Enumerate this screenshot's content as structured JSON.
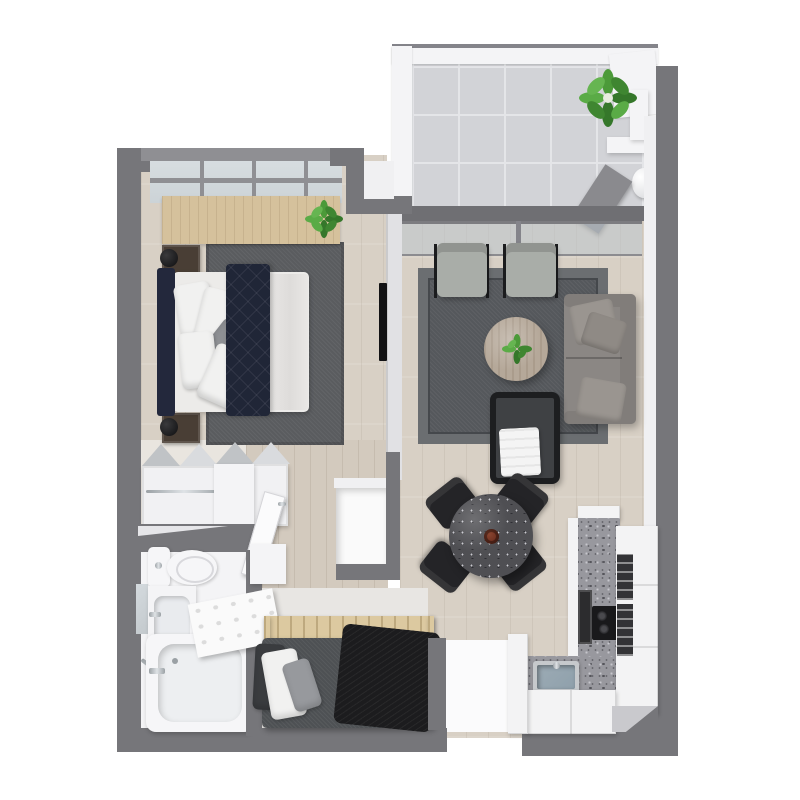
{
  "meta": {
    "title": "3D apartment floor plan render, top-down view",
    "render_type": "3d-floor-plan",
    "canvas": {
      "width": 800,
      "height": 800
    },
    "visible_text": "none"
  },
  "palette": {
    "wall": "#76767a",
    "wall_light": "#8f8f93",
    "wall_face": "#f0f0f2",
    "floor_wood": "#d8d0c5",
    "hall_wood": "#d3cabe",
    "den_floor": "#e8e6e3",
    "bath_floor": "#f4f4f6",
    "closet_floor": "#e9e5df",
    "tile": "#d2d3d7",
    "tile_line": "#e4e5e8",
    "rug_dark": "#5a5c5f",
    "rug_living": "#55585c",
    "rug_border": "#6b6e71",
    "navy": "#202637",
    "navy_dark": "#23283c",
    "mattress": "#ecebe9",
    "pillow": "#f1f1f0",
    "wood_desk": "#d5c19c",
    "wood_slat": "#dcc9a0",
    "nightstand": "#493e35",
    "sofa": "#8b8784",
    "sofa_pillow": "#9a9590",
    "chair_fabric": "#a9ada8",
    "table_wood": "#b5a899",
    "stone_table": "#4f4f53",
    "vase": "#5c2317",
    "chair_black": "#242427",
    "granite": "#98989e",
    "cabinet_white": "#f3f3f4",
    "appliance_dark": "#2c2c2e",
    "sink": "#8fa0ab",
    "plant_green": "#4c9a39",
    "plant_dark": "#35772a",
    "blanket_white": "#f4f4f4",
    "den_duvet": "#4e5154",
    "throw_black": "#1c1c1e",
    "glass": "#ccd3d7",
    "mirror": "#c3c9cd",
    "white_fixture": "#f4f4f6"
  },
  "rooms": [
    {
      "id": "balcony",
      "label": "balcony",
      "furniture": [
        "potted-plant",
        "water-heater-unit",
        "utility-door",
        "sliding-glass-door",
        "tile-floor"
      ]
    },
    {
      "id": "bedroom",
      "label": "bedroom",
      "furniture": [
        "window-wall",
        "wood-desk-counter",
        "desk-plant",
        "nightstand-left-top",
        "nightstand-left-bottom",
        "table-lamp-top",
        "table-lamp-bottom",
        "queen-bed",
        "headboard",
        "white-pillows",
        "gray-accent-pillow",
        "navy-quilted-duvet",
        "area-rug",
        "wall-mounted-tv"
      ]
    },
    {
      "id": "living-room",
      "label": "living-room",
      "furniture": [
        "accent-chair-left",
        "accent-chair-right",
        "round-wood-coffee-table",
        "coffee-table-plant",
        "gray-sofa",
        "sofa-pillows",
        "black-lounge-chair",
        "white-throw-blanket",
        "area-rug"
      ]
    },
    {
      "id": "dining-area",
      "label": "dining-area",
      "furniture": [
        "round-stone-dining-table",
        "center-vase",
        "dining-chair-nw",
        "dining-chair-ne",
        "dining-chair-sw",
        "dining-chair-se"
      ]
    },
    {
      "id": "kitchen",
      "label": "kitchen",
      "furniture": [
        "l-shaped-granite-counter",
        "undermount-sink",
        "faucet",
        "cooktop",
        "oven-front",
        "glass-front-appliance-upper",
        "glass-front-appliance-lower",
        "tall-cabinet-column",
        "base-cabinets",
        "corner-door-wedge"
      ]
    },
    {
      "id": "walk-in-closet",
      "label": "walk-in-closet",
      "furniture": [
        "shelving-unit-left",
        "shelving-unit-right",
        "hanging-rod",
        "wardrobe-box",
        "bedroom-door"
      ]
    },
    {
      "id": "bathroom",
      "label": "bathroom",
      "furniture": [
        "toilet",
        "vanity-with-sink",
        "mirror",
        "towel-bar",
        "bathtub",
        "tub-faucet"
      ]
    },
    {
      "id": "den",
      "label": "den-second-bedroom",
      "furniture": [
        "murphy-bed-wood-slat-frame",
        "fold-out-desk-panel",
        "dark-gray-duvet",
        "black-throw-blanket",
        "pillow-dark",
        "pillow-white",
        "pillow-gray",
        "wall-shelf-box"
      ]
    },
    {
      "id": "hallway",
      "label": "hallway",
      "furniture": [
        "storage-closet"
      ]
    },
    {
      "id": "entry",
      "label": "entry",
      "furniture": [
        "entry-floor"
      ]
    }
  ]
}
